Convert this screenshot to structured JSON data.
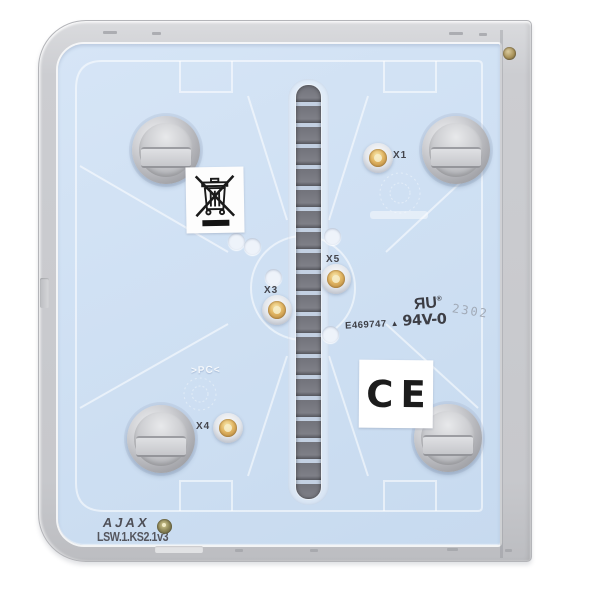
{
  "device": {
    "type": "smart light-switch button back panel",
    "frame_color": "#cdced1",
    "panel_color": "#cfe0f3"
  },
  "markings": {
    "brand": "AJAX",
    "model": "LSW.1.KS2.1v3",
    "material": ">PC<",
    "date_code": "2302"
  },
  "certifications": {
    "ce": "CE",
    "ul_file": "E469747",
    "ul_triangle": "▲",
    "ul_rating": "94V-0",
    "ul_mark_r": "R",
    "ul_mark_u": "U",
    "ul_registered": "®"
  },
  "terminals": [
    {
      "label": "X1"
    },
    {
      "label": "X3"
    },
    {
      "label": "X4"
    },
    {
      "label": "X5"
    }
  ]
}
